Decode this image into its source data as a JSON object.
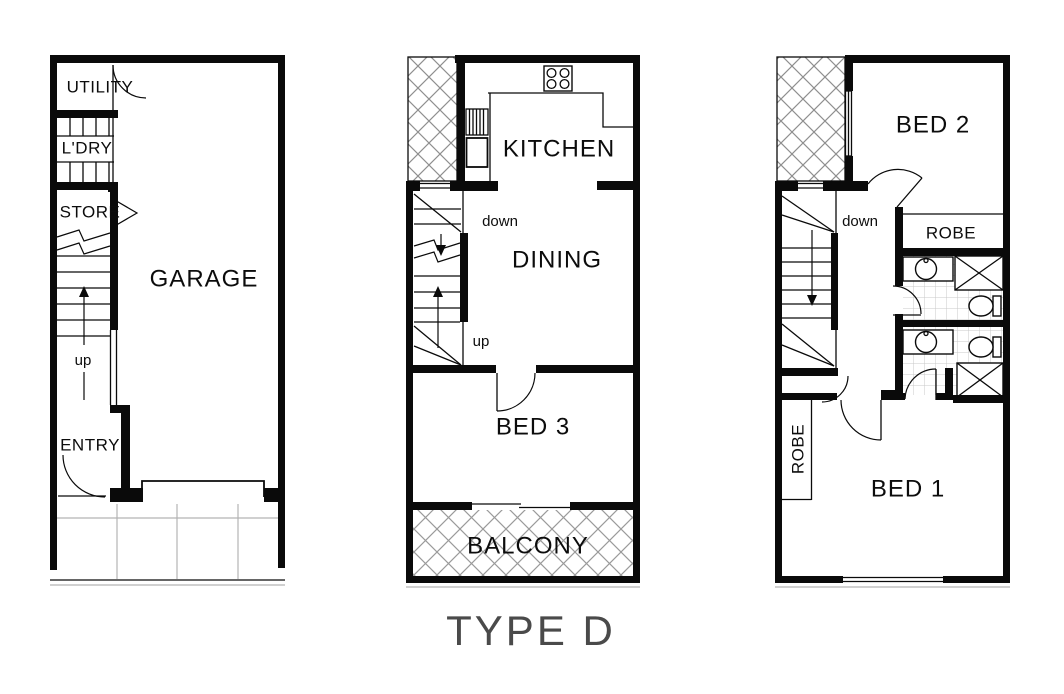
{
  "title": "TYPE D",
  "colors": {
    "wall": "#0a0a0a",
    "hatch": "#8f8f8f",
    "balcony_hatch": "#9a9a9a",
    "driveway_lines": "#b3b3b3",
    "tile_lines": "#c9c9c9",
    "title_text": "#4a4a4a",
    "background": "#ffffff"
  },
  "plans": {
    "garage_level": {
      "rooms": {
        "utility": "UTILITY",
        "laundry": "L'DRY",
        "store": "STORE",
        "garage": "GARAGE",
        "entry": "ENTRY"
      },
      "annotations": {
        "up": "up"
      }
    },
    "living_level": {
      "rooms": {
        "kitchen": "KITCHEN",
        "dining": "DINING",
        "bed3": "BED 3",
        "balcony": "BALCONY"
      },
      "annotations": {
        "down": "down",
        "up": "up"
      }
    },
    "bedroom_level": {
      "rooms": {
        "bed2": "BED 2",
        "robe_bed2": "ROBE",
        "robe_bed1": "ROBE",
        "bed1": "BED 1"
      },
      "annotations": {
        "down": "down"
      }
    }
  }
}
